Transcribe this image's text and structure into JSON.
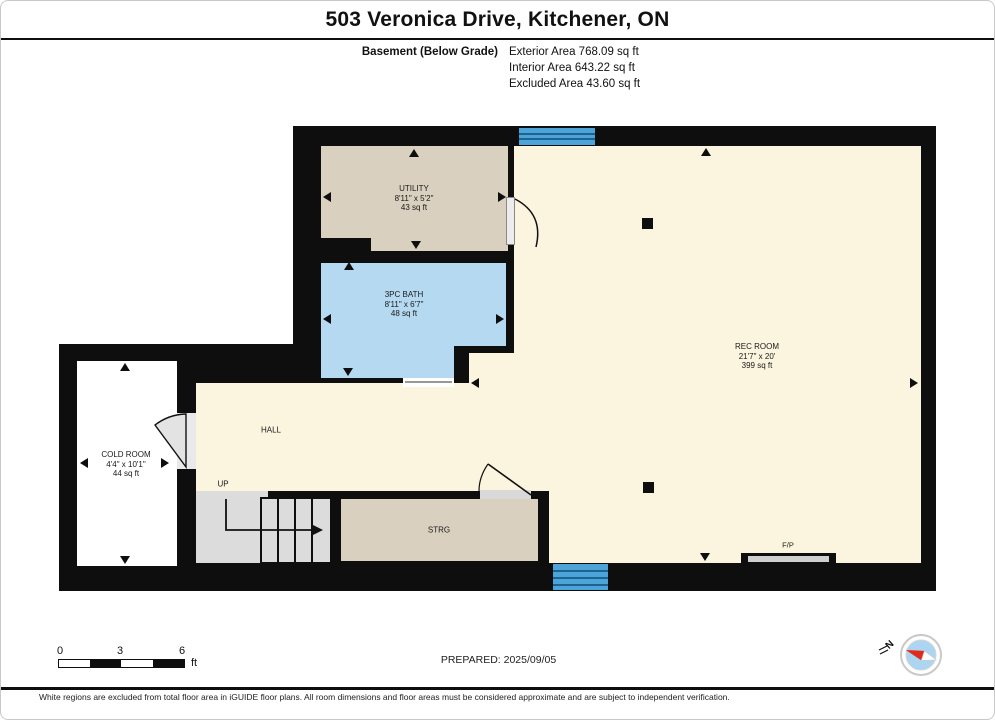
{
  "header": {
    "title": "503 Veronica Drive, Kitchener, ON",
    "floor_label": "Basement (Below Grade)",
    "areas": [
      "Exterior Area 768.09 sq ft",
      "Interior Area 643.22 sq ft",
      "Excluded Area 43.60 sq ft"
    ]
  },
  "rooms": [
    {
      "name": "UTILITY",
      "dims": "8'11\" x 5'2\"",
      "area": "43 sq ft"
    },
    {
      "name": "3PC BATH",
      "dims": "8'11\" x 6'7\"",
      "area": "48 sq ft"
    },
    {
      "name": "REC ROOM",
      "dims": "21'7\" x 20'",
      "area": "399 sq ft"
    },
    {
      "name": "COLD ROOM",
      "dims": "4'4\" x 10'1\"",
      "area": "44 sq ft"
    },
    {
      "name": "HALL"
    },
    {
      "name": "STRG"
    }
  ],
  "plan_labels": {
    "up": "UP",
    "fireplace": "F/P"
  },
  "scale_bar": {
    "ticks": [
      "0",
      "3",
      "6"
    ],
    "unit": "ft"
  },
  "prepared_label": "PREPARED: 2025/09/05",
  "compass": {
    "north_label": "N"
  },
  "footer": "White regions are excluded from total floor area in iGUIDE floor plans. All room dimensions and floor areas must be considered approximate and are subject to independent verification.",
  "colors": {
    "wall": "#0e0e0e",
    "rec_room_fill": "#fbf4de",
    "utility_fill": "#d9d0bf",
    "bath_fill": "#b5d9f1",
    "cold_room_fill": "#ffffff",
    "stairs_fill": "#dcdcdc",
    "window_fill": "#4ca4d8",
    "window_line": "#1d6390",
    "compass_needle_red": "#e02b20",
    "compass_face": "#abd5f0"
  }
}
